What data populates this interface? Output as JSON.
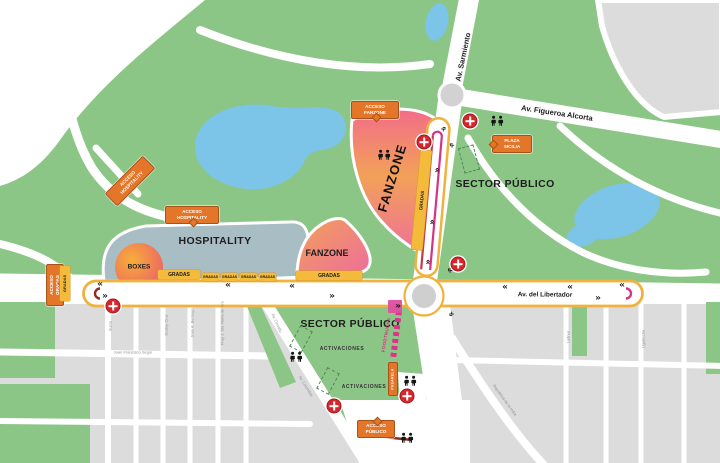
{
  "labels": {
    "av_sarmiento": "Av. Sarmiento",
    "av_figueroa_alcorta": "Av. Figueroa Alcorta",
    "av_del_libertador": "Av. del Libertador",
    "av_colombia": "Av. Colombia",
    "av_cervino": "Av. Cerviño",
    "sector_publico": "SECTOR PÚBLICO",
    "hospitality": "HOSPITALITY",
    "fanzone": "FANZONE",
    "boxes": "BOXES",
    "gradas": "GRADAS",
    "activaciones": "ACTIVACIONES",
    "foodtrucks": "FOODTRUCKS",
    "pasarela": "PASARELA"
  },
  "tags": {
    "acceso_fanzone": {
      "line1": "ACCESO",
      "line2": "FANZONE"
    },
    "acceso_hospitality_path": {
      "line1": "ACCESO",
      "line2": "HOSPITALITY"
    },
    "acceso_hospitality": {
      "line1": "ACCESO",
      "line2": "HOSPITALITY"
    },
    "acceso_gradas": {
      "line1": "ACCESO",
      "line2": "GRADAS"
    },
    "acceso_publico": {
      "line1": "ACCESO",
      "line2": "PÚBLICO"
    },
    "plaza_sicilia": {
      "line1": "PLAZA",
      "line2": "SICILIA"
    }
  },
  "streets": {
    "segui": "Juan Francisco Seguí",
    "w1": "Sucre",
    "w2": "Godoy Cruz",
    "w3": "José A. Bermejo",
    "w4": "Fray J. Sta María de Oro",
    "lafinur": "Lafinur",
    "ugarteche": "Ugarteche",
    "republica_india": "República de la India"
  },
  "glyphs": {
    "chevron_left": "«",
    "chevron_right": "»"
  },
  "icons": {
    "medical_cross": "white plus on red circle",
    "restroom": "two black person silhouettes",
    "stage_area": "green dashed rectangle",
    "direction_chevron": "black guillemet arrows on track",
    "roundabout": "gray circle with white ring"
  },
  "colors": {
    "park_green": "#8cc687",
    "water_blue": "#7cc4e8",
    "city_gray": "#dcdcdc",
    "hospitality_gray": "#a9bdc5",
    "zone_orange": "#f2a158",
    "zone_pink": "#ee6d9d",
    "track_yellow": "#f0b23c",
    "line_maroon": "#8f2e1e",
    "line_magenta": "#d63384",
    "line_orange": "#dd7b2b",
    "tag_orange": "#e4762a",
    "cross_red": "#d9262c",
    "gradas_yellow": "#f3ba3c"
  }
}
